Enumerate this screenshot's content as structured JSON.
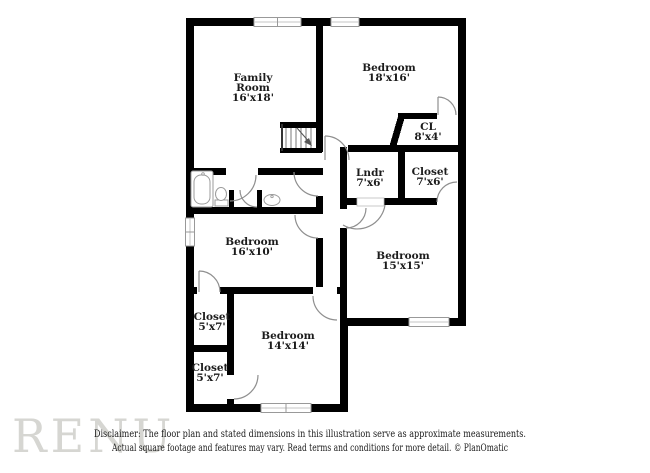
{
  "watermark": {
    "text": "RENU",
    "color": "#d6d6d2"
  },
  "plan": {
    "wall_color": "#000000",
    "label_color": "#1c1c1c",
    "rooms": {
      "family_room": {
        "line1": "Family",
        "line2": "Room",
        "dims": "16'x18'"
      },
      "bedroom_top_right": {
        "name": "Bedroom",
        "dims": "18'x16'"
      },
      "closet_cl": {
        "name": "CL",
        "dims": "8'x4'"
      },
      "laundry": {
        "name": "Lndr",
        "dims": "7'x6'"
      },
      "closet_top_right": {
        "name": "Closet",
        "dims": "7'x6'"
      },
      "bedroom_mid_left": {
        "name": "Bedroom",
        "dims": "16'x10'"
      },
      "bedroom_mid_right": {
        "name": "Bedroom",
        "dims": "15'x15'"
      },
      "closet_bottom_upper": {
        "name": "Closet",
        "dims": "5'x7'"
      },
      "bedroom_bottom": {
        "name": "Bedroom",
        "dims": "14'x14'"
      },
      "closet_bottom_lower": {
        "name": "Closet",
        "dims": "5'x7'"
      }
    }
  },
  "footer": {
    "line1": "Disclaimer: The floor plan and stated dimensions in this illustration serve as approximate measurements.",
    "line2": "Actual square footage and features may vary. Read terms and conditions for more detail. © PlanOmatic"
  }
}
